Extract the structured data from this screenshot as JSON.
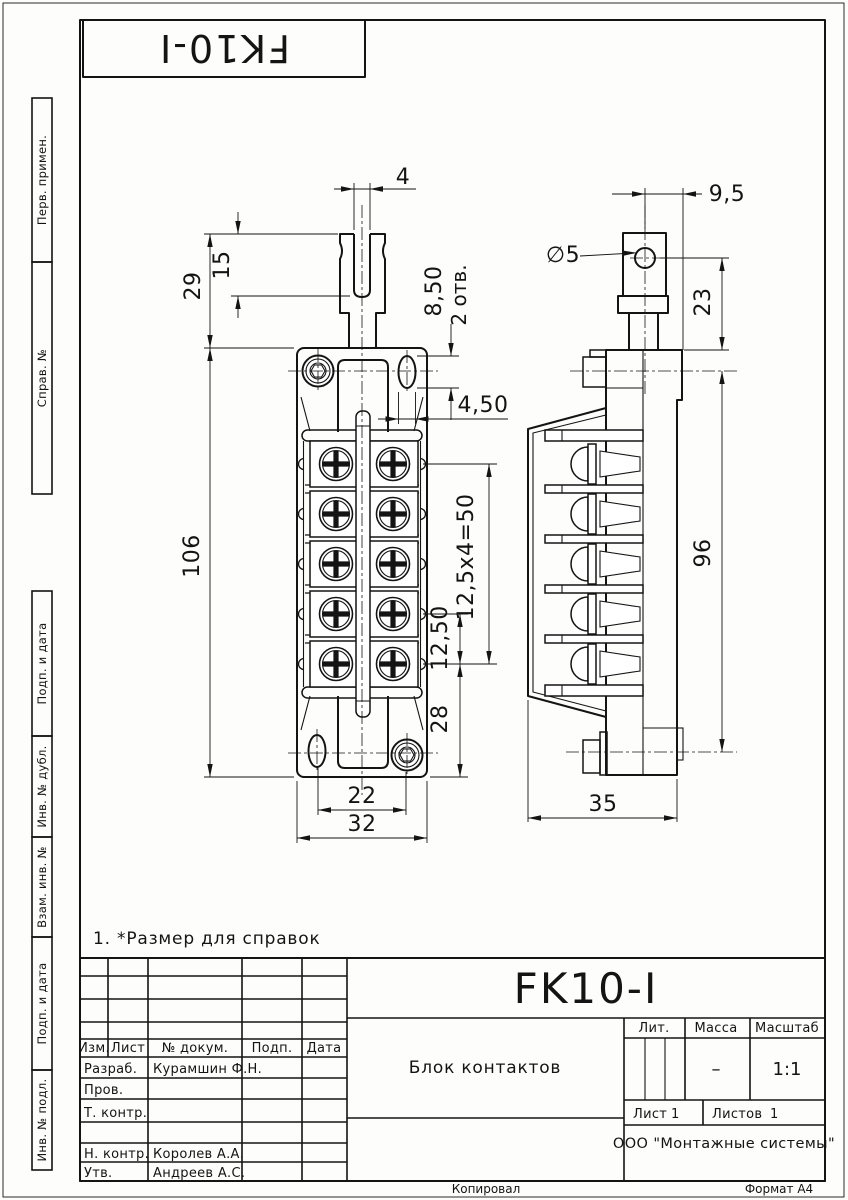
{
  "stamp_top": {
    "designation": "FK10-I"
  },
  "margin_stamps": {
    "items": [
      {
        "label": "Перв. примен."
      },
      {
        "label": "Справ. №"
      },
      {
        "label": "Подп. и дата"
      },
      {
        "label": "Инв. № дубл."
      },
      {
        "label": "Взам. инв. №"
      },
      {
        "label": "Подп. и дата"
      },
      {
        "label": "Инв. № подл."
      }
    ]
  },
  "note": {
    "text": "1. *Размер для справок"
  },
  "front_view": {
    "dims": {
      "slot_width": "4",
      "slot_depth": "15",
      "tab_height": "29",
      "mount_hole_height": "8,50",
      "mount_hole_qty": "2 отв.",
      "mount_hole_width": "4,50",
      "body_height": "106",
      "terminal_pitch_total": "12,5x4=50",
      "terminal_pitch": "12,50",
      "bottom_offset": "28",
      "mount_spacing": "22",
      "body_width": "32"
    }
  },
  "side_view": {
    "dims": {
      "hole_dia": "∅5",
      "tab_offset": "9,5",
      "tab_to_body": "23",
      "mount_span": "96",
      "depth": "35"
    }
  },
  "title_block": {
    "designation": "FK10-I",
    "part_name": "Блок контактов",
    "headers": {
      "izm": "Изм.",
      "list": "Лист",
      "dokum": "№ докум.",
      "podp": "Подп.",
      "data": "Дата"
    },
    "rows": {
      "razrab_label": "Разраб.",
      "razrab_name": "Курамшин Ф.Н.",
      "prov_label": "Пров.",
      "tkontr_label": "Т. контр.",
      "nkontr_label": "Н. контр.",
      "nkontr_name": "Королев А.А.",
      "utv_label": "Утв.",
      "utv_name": "Андреев А.С."
    },
    "lit_label": "Лит.",
    "massa_label": "Масса",
    "masshtab_label": "Масштаб",
    "massa_value": "–",
    "scale_value": "1:1",
    "sheet_label": "Лист",
    "sheet_value": "1",
    "sheets_label": "Листов",
    "sheets_value": "1",
    "company": "ООО \"Монтажные системы\""
  },
  "footer": {
    "copied": "Копировал",
    "format": "Формат А4"
  }
}
